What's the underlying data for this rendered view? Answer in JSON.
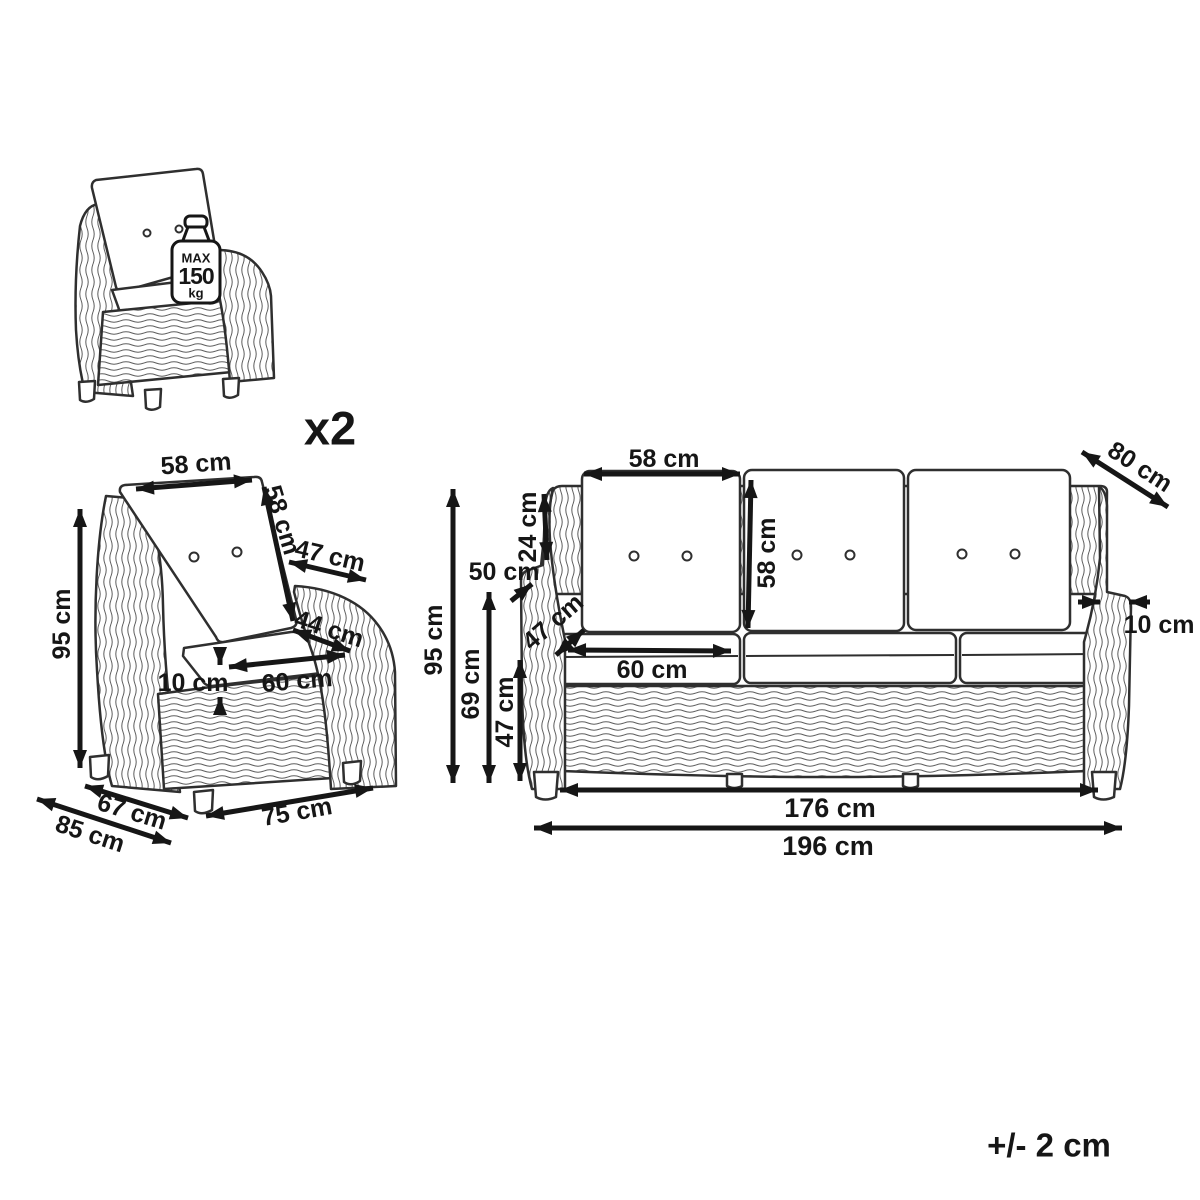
{
  "quantity_label": "x2",
  "weight_limit": {
    "max": "MAX",
    "value": "150",
    "unit": "kg"
  },
  "tolerance": "+/- 2 cm",
  "chair": {
    "back_cushion_width": "58 cm",
    "back_cushion_height": "58 cm",
    "armrest_length": "47 cm",
    "seat_depth": "44 cm",
    "seat_width": "60 cm",
    "seat_cushion_thickness": "10 cm",
    "total_height": "95 cm",
    "base_depth": "67 cm",
    "total_depth": "85 cm",
    "total_width": "75 cm"
  },
  "sofa": {
    "back_cushion_width": "58 cm",
    "back_cushion_height": "58 cm",
    "total_depth": "80 cm",
    "backrest_above_armrest_height": "24 cm",
    "armrest_height": "50 cm",
    "seat_depth": "47 cm",
    "seat_width": "60 cm",
    "armrest_width": "10 cm",
    "total_height": "95 cm",
    "backrest_height": "69 cm",
    "seat_height": "47 cm",
    "inner_width": "176 cm",
    "total_width": "196 cm"
  }
}
